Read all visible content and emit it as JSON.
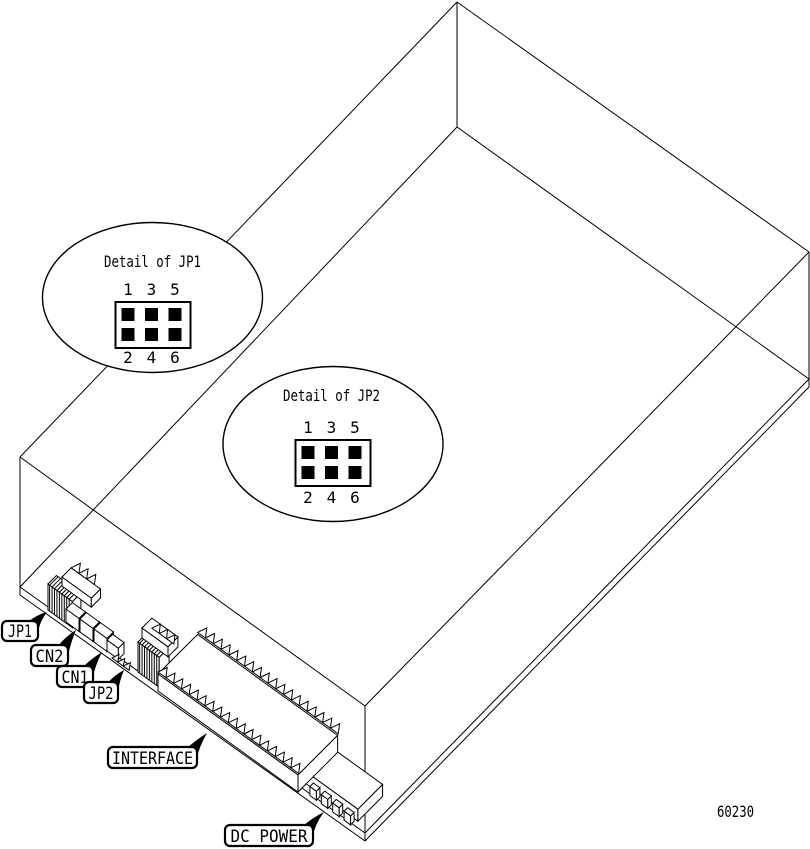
{
  "figure": {
    "number": "60230"
  },
  "callouts": [
    {
      "label": "JP1"
    },
    {
      "label": "CN2"
    },
    {
      "label": "CN1"
    },
    {
      "label": "JP2"
    },
    {
      "label": "INTERFACE"
    },
    {
      "label": "DC POWER"
    }
  ],
  "details": [
    {
      "title": "Detail of JP1",
      "top_pins": [
        "1",
        "3",
        "5"
      ],
      "bottom_pins": [
        "2",
        "4",
        "6"
      ],
      "pin_grid": {
        "rows": 2,
        "cols": 3
      }
    },
    {
      "title": "Detail of JP2",
      "top_pins": [
        "1",
        "3",
        "5"
      ],
      "bottom_pins": [
        "2",
        "4",
        "6"
      ],
      "pin_grid": {
        "rows": 2,
        "cols": 3
      }
    }
  ],
  "colors": {
    "line": "#000000",
    "background": "#ffffff"
  }
}
